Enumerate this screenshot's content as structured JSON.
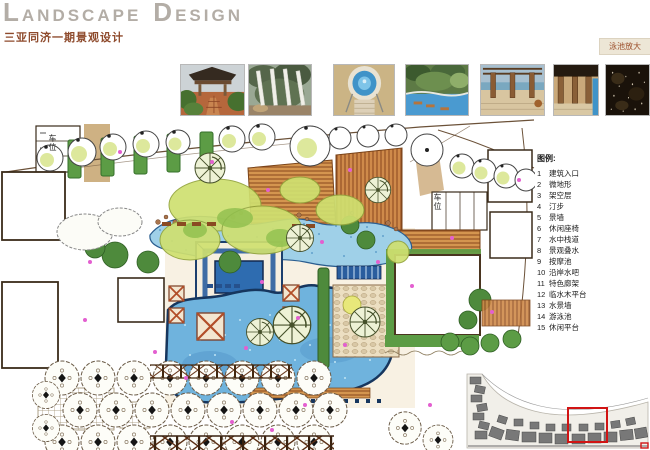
{
  "header": {
    "title_word1": "LANDSCAPE",
    "title_word2": "DESIGN",
    "subtitle": "三亚同济一期景观设计"
  },
  "tabs": {
    "pool_zoom": "泳池放大"
  },
  "photos": {
    "items": [
      {
        "name": "garden-pavilion"
      },
      {
        "name": "white-pergola"
      },
      {
        "name": "round-spa-pool"
      },
      {
        "name": "resort-pool-garden"
      },
      {
        "name": "seaview-pergola-terrace"
      },
      {
        "name": "pool-colonnade"
      },
      {
        "name": "dark-water-texture"
      }
    ]
  },
  "plan": {
    "parking_label_left": "车位",
    "parking_label_right": "车位"
  },
  "legend": {
    "title": "图例:",
    "items": [
      {
        "num": "1",
        "label": "建筑入口"
      },
      {
        "num": "2",
        "label": "微地形"
      },
      {
        "num": "3",
        "label": "架空层"
      },
      {
        "num": "4",
        "label": "汀步"
      },
      {
        "num": "5",
        "label": "景墙"
      },
      {
        "num": "6",
        "label": "休闲座椅"
      },
      {
        "num": "7",
        "label": "水中栈道"
      },
      {
        "num": "8",
        "label": "景观叠水"
      },
      {
        "num": "9",
        "label": "按摩池"
      },
      {
        "num": "10",
        "label": "沿岸水吧"
      },
      {
        "num": "11",
        "label": "特色廊架"
      },
      {
        "num": "12",
        "label": "临水木平台"
      },
      {
        "num": "13",
        "label": "水景墙"
      },
      {
        "num": "14",
        "label": "游泳池"
      },
      {
        "num": "15",
        "label": "休闲平台"
      }
    ]
  },
  "colors": {
    "title_gray": "#b3ada6",
    "accent_brown": "#8e4a2c",
    "pool_blue": "#6fb3dd",
    "canopy_green": "#cfe070",
    "highlight_red": "#d11414"
  }
}
